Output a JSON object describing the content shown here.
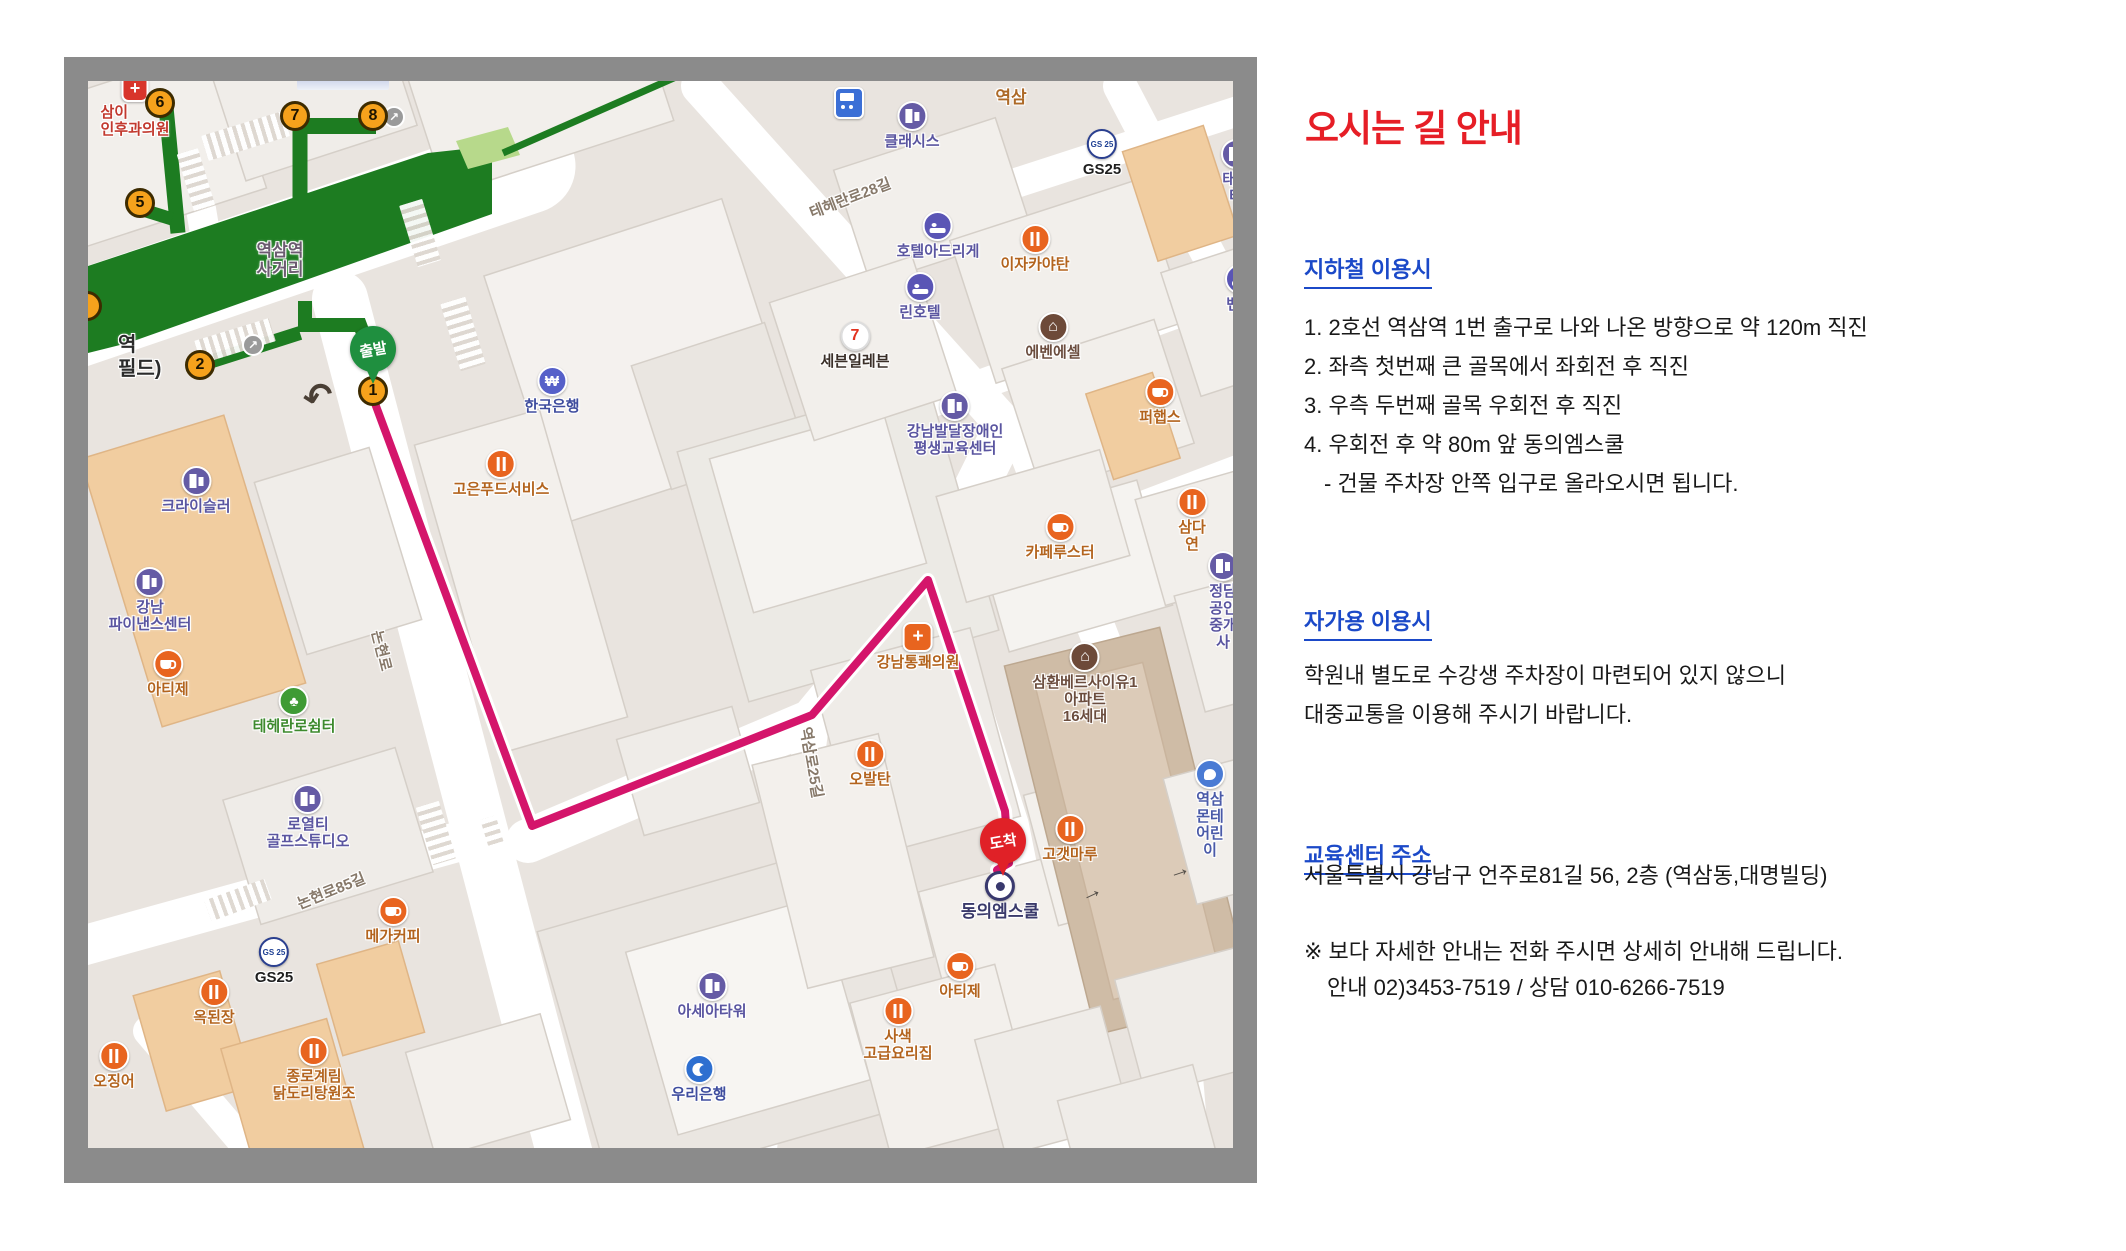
{
  "colors": {
    "title_red": "#e61e26",
    "heading_blue": "#1b49c8",
    "route_pink": "#d4156b",
    "subway_green": "#1d7c21",
    "map_border_gray": "#8b8b8b"
  },
  "panel": {
    "title": "오시는 길 안내",
    "subway_heading": "지하철 이용시",
    "subway_steps": "1. 2호선 역삼역 1번 출구로 나와 나온 방향으로 약 120m 직진\n2. 좌측 첫번째 큰 골목에서 좌회전 후  직진\n3. 우측 두번째 골목 우회전 후 직진\n4. 우회전 후 약 80m 앞 동의엠스쿨",
    "subway_note": "- 건물 주차장 안쪽 입구로 올라오시면 됩니다.",
    "car_heading": "자가용 이용시",
    "car_text": "학원내 별도로 수강생 주차장이 마련되어 있지 않으니\n대중교통을 이용해 주시기 바랍니다.",
    "addr_heading": "교육센터 주소",
    "address": "서울특별시 강남구 언주로81길 56, 2층 (역삼동,대명빌딩)",
    "notice": "※ 보다 자세한 안내는 전화 주시면 상세히 안내해 드립니다.",
    "phone": "안내 02)3453-7519  / 상담 010-6266-7519"
  },
  "map": {
    "start_label": "출발",
    "arrive_label": "도착",
    "exits": [
      {
        "n": "1"
      },
      {
        "n": "2"
      },
      {
        "n": "5"
      },
      {
        "n": "6"
      },
      {
        "n": "7"
      },
      {
        "n": "8"
      }
    ],
    "pois": [
      {
        "label": "클래시스"
      },
      {
        "label": "역삼"
      },
      {
        "label": "GS25"
      },
      {
        "label": "태광타"
      },
      {
        "label": "호텔아드리게"
      },
      {
        "label": "이자카야탄"
      },
      {
        "label": "린호텔"
      },
      {
        "label": "벤모텔"
      },
      {
        "label": "에벤에셀"
      },
      {
        "label": "세븐일레븐"
      },
      {
        "label": "퍼햅스"
      },
      {
        "label": "강남발달장애인\n평생교육센터"
      },
      {
        "label": "카페루스터"
      },
      {
        "label": "삼다연"
      },
      {
        "label": "정담\n공인중개사"
      },
      {
        "label": "한국은행"
      },
      {
        "label": "고은푸드서비스"
      },
      {
        "label": "크라이슬러"
      },
      {
        "label": "강남\n파이낸스센터"
      },
      {
        "label": "아티제"
      },
      {
        "label": "테헤란로쉼터"
      },
      {
        "label": "로열티\n골프스튜디오"
      },
      {
        "label": "강남통쾌의원"
      },
      {
        "label": "오발탄"
      },
      {
        "label": "삼환베르사이유1\n아파트\n16세대"
      },
      {
        "label": "역삼몬테\n어린이"
      },
      {
        "label": "고갯마루"
      },
      {
        "label": "동의엠스쿨"
      },
      {
        "label": "아티제"
      },
      {
        "label": "사색\n고급요리집"
      },
      {
        "label": "아세아타워"
      },
      {
        "label": "우리은행"
      },
      {
        "label": "메가커피"
      },
      {
        "label": "GS25"
      },
      {
        "label": "옥된장"
      },
      {
        "label": "오징어"
      },
      {
        "label": "종로계림\n닭도리탕원조"
      },
      {
        "label": "삼이\n인후과의원"
      },
      {
        "label": "역삼역\n사거리"
      },
      {
        "label": "논현로"
      },
      {
        "label": "논현로85길"
      },
      {
        "label": "역삼로25길"
      },
      {
        "label": "테헤란로28길"
      },
      {
        "label": "역\n필드)"
      }
    ],
    "gs_icon_text": "GS\n25",
    "seven_icon_text": "7",
    "bank_icon_text": "₩",
    "apt_icon_text": "⌂",
    "park_icon_text": "♣",
    "cross_icon_text": "+",
    "uturn_glyph": "↶",
    "oneway_glyph": "→",
    "camera_glyph": "↗"
  }
}
